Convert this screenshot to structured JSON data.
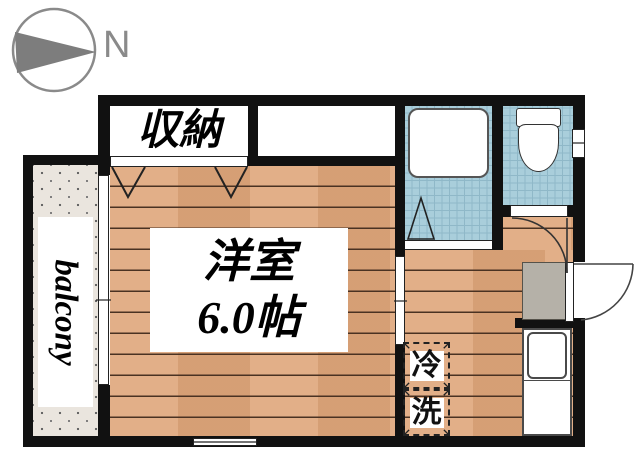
{
  "compass": {
    "label": "N"
  },
  "closet": {
    "label": "収納"
  },
  "room": {
    "name": "洋室",
    "size": "6.0帖"
  },
  "balcony": {
    "label": "balcony"
  },
  "appliances": {
    "fridge": "冷",
    "washer": "洗"
  },
  "colors": {
    "wall": "#111111",
    "wood": "#e0a97f",
    "plank": "#4a3222",
    "tile": "#a9cedb",
    "tile_line": "#8fb8c8",
    "balcony_floor": "#eae5de",
    "genkan": "#b5b1a8",
    "compass_gray": "#8a8a8a"
  }
}
